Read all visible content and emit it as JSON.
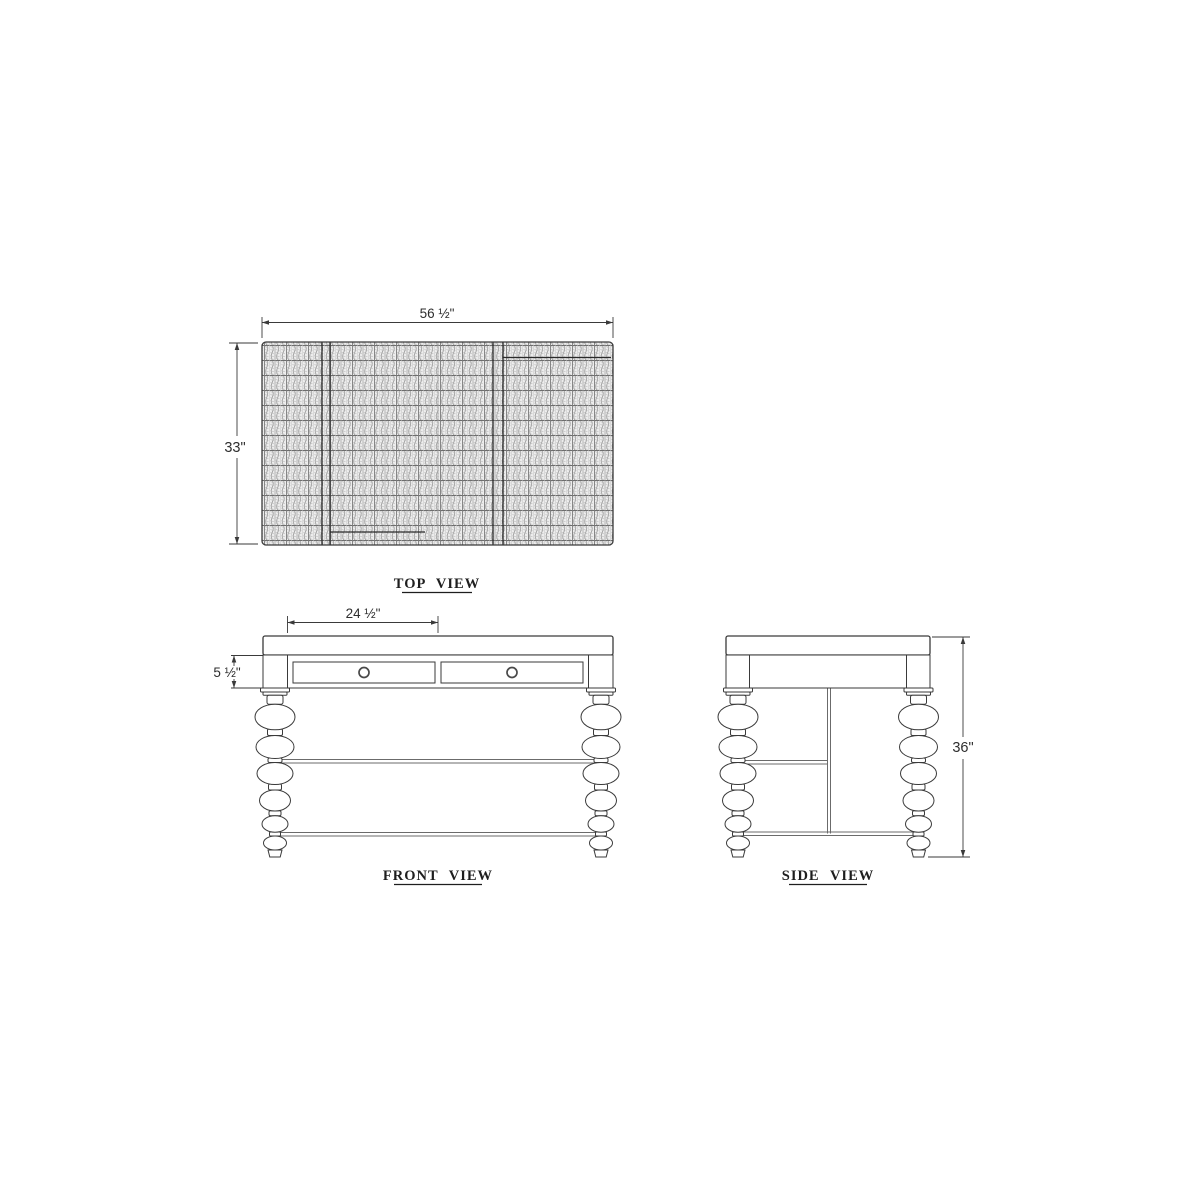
{
  "views": {
    "top": {
      "label": "TOP VIEW",
      "width_dim": "56 ½\"",
      "depth_dim": "33\""
    },
    "front": {
      "label": "FRONT VIEW",
      "opening_width_dim": "24 ½\"",
      "apron_height_dim": "5 ½\""
    },
    "side": {
      "label": "SIDE VIEW",
      "height_dim": "36\""
    }
  },
  "style": {
    "ink_color": "#3a3a3a",
    "texture_color": "#9a9a9a",
    "background_color": "#ffffff"
  }
}
